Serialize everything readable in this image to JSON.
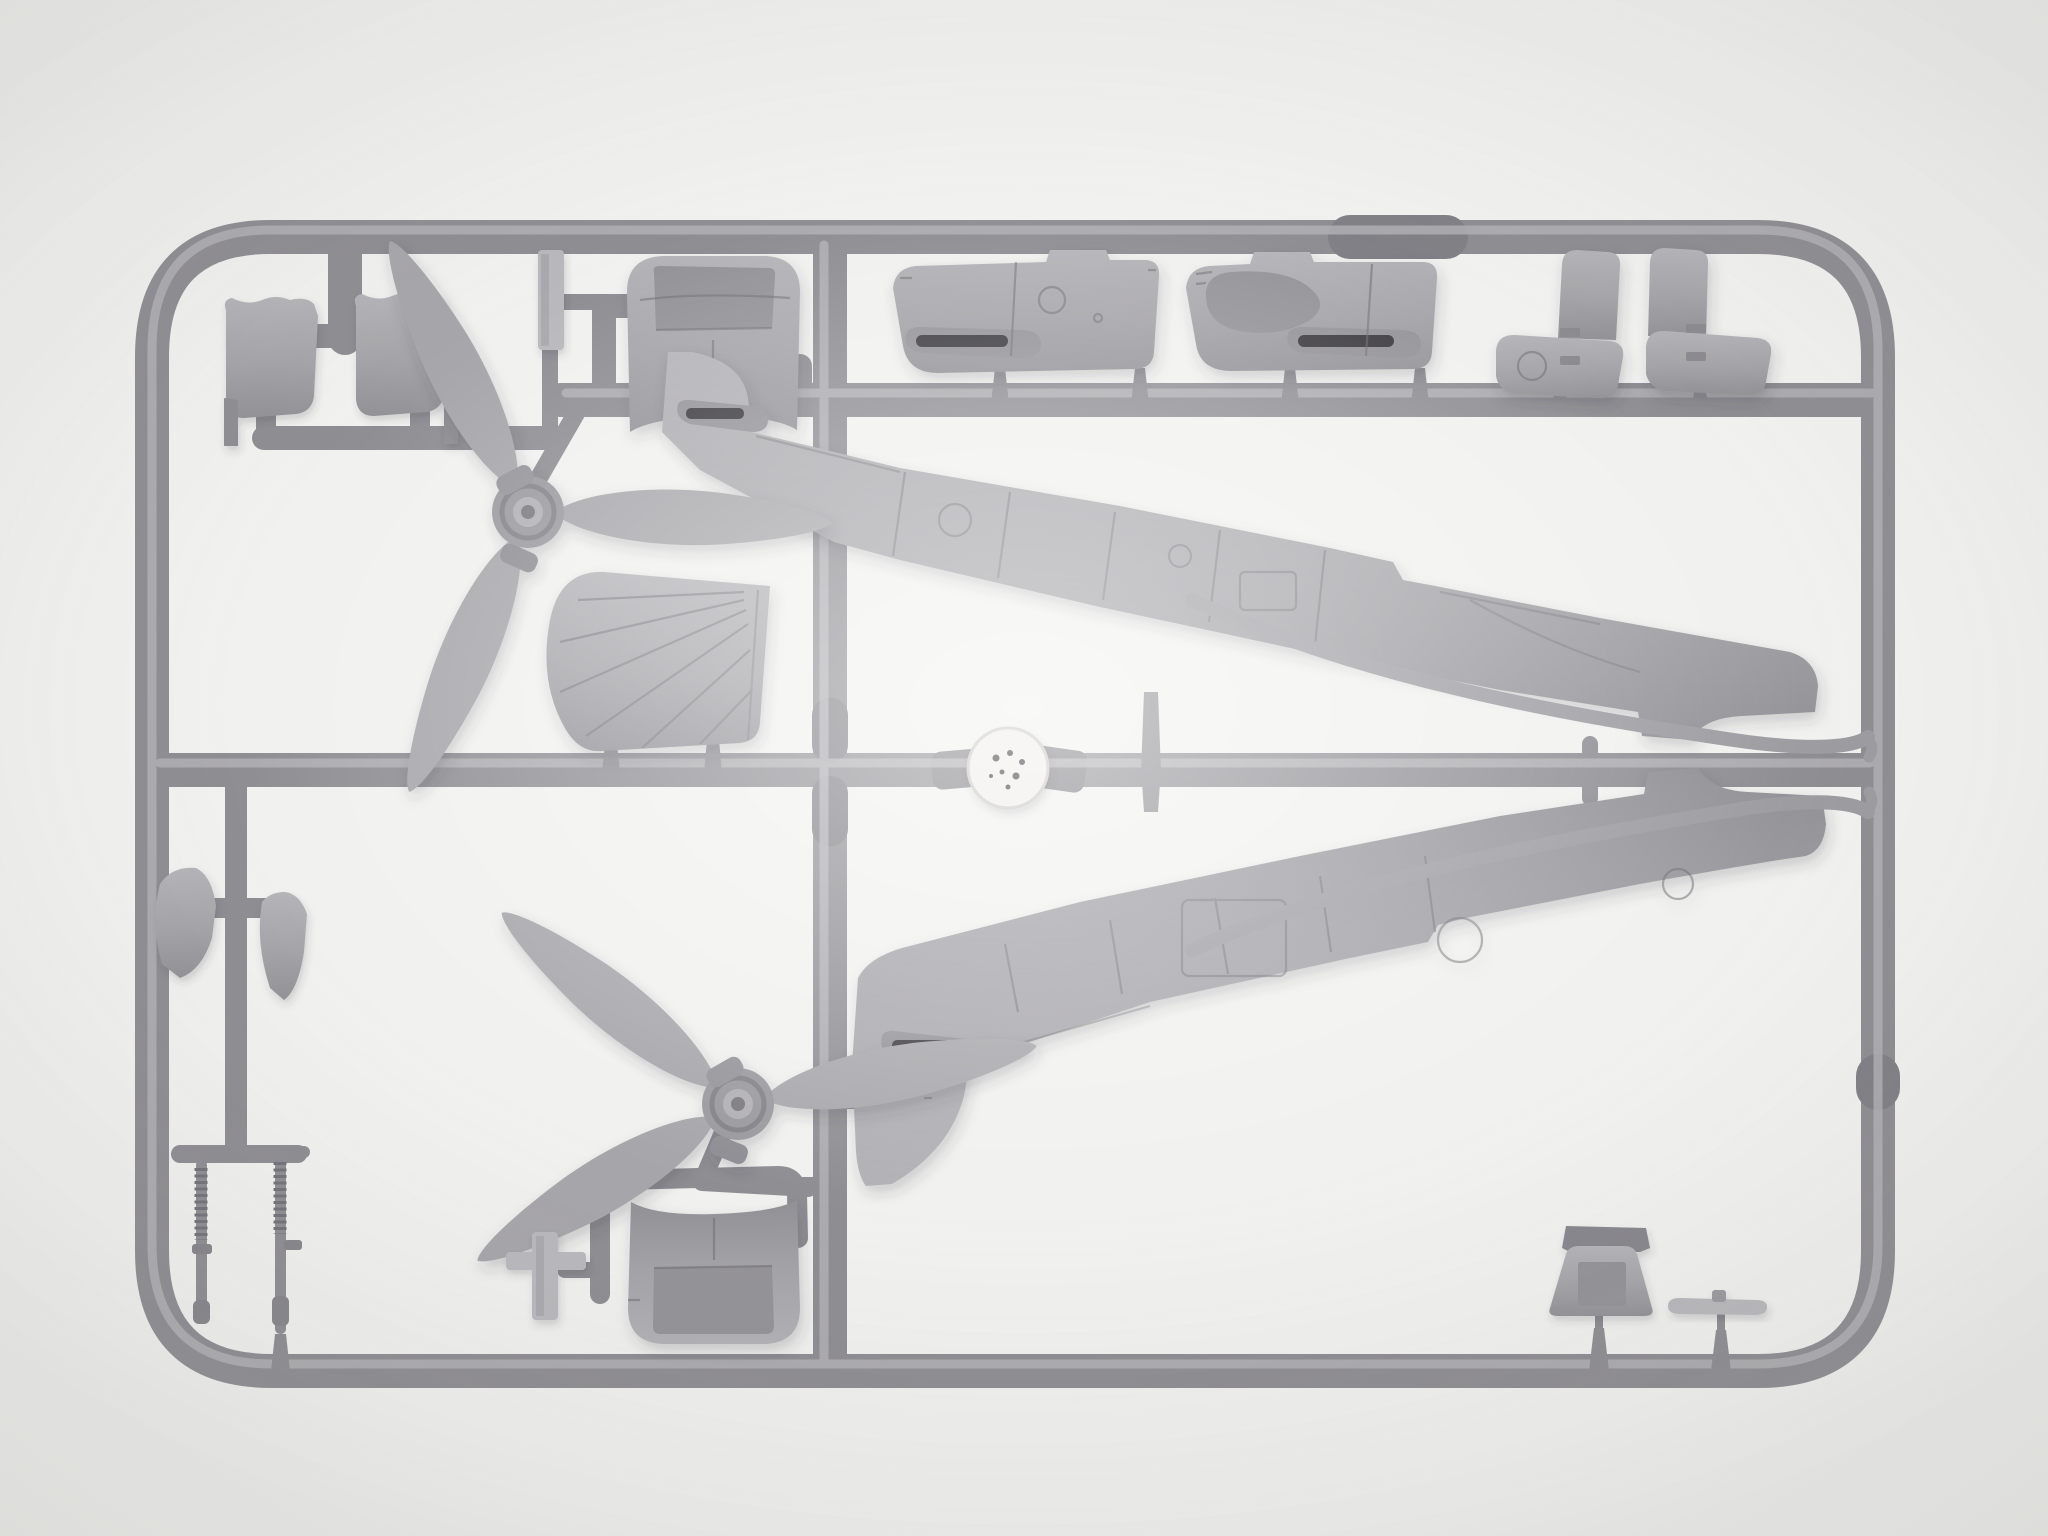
{
  "meta": {
    "type": "product-photo",
    "subject": "Injection-molded plastic model aircraft kit sprue, unpainted light gray styrene parts on a rectangular runner frame, photographed on a white background",
    "orientation": "landscape"
  },
  "scene": {
    "background": "white seamless studio background with soft vignette",
    "frame": "rounded rectangular sprue runner frame with internal runners, sleeves and tapered gates",
    "material": "light gray polystyrene",
    "lighting": "soft top light with faint drop shadows under parts"
  },
  "parts_inventory": [
    {
      "name": "fuselage half (side view, tail fin and panel lines)",
      "count": 2
    },
    {
      "name": "three-blade propeller with hub",
      "count": 2
    },
    {
      "name": "engine cowling side panel with exhaust trough",
      "count": 2
    },
    {
      "name": "nose cowl section (column + curved trough)",
      "count": 2
    },
    {
      "name": "fuselage spine / cowl deck saddle piece",
      "count": 2
    },
    {
      "name": "ribbed radiator fairing (D-shaped)",
      "count": 1
    },
    {
      "name": "windscreen frame part",
      "count": 1
    },
    {
      "name": "main landing gear leg with knurled oleo",
      "count": 2
    },
    {
      "name": "small curved bulkhead / head-armor plate",
      "count": 2
    },
    {
      "name": "small fin / wheel-door blade",
      "count": 2
    },
    {
      "name": "flat strip part",
      "count": 2
    },
    {
      "name": "curved exhaust fairing strip",
      "count": 2
    },
    {
      "name": "small flat tailplane blade",
      "count": 1
    },
    {
      "name": "round molding stamp disc on runner",
      "count": 1
    }
  ],
  "colors": {
    "background": "#f1f1ef",
    "sprue_base": "#8f8e93",
    "sprue_dark": "#818086",
    "sprue_highlight": "#b6b5b9",
    "part_fill": "#a7a6aa",
    "part_light": "#b9b8bc",
    "part_dark": "#8a898e",
    "recess": "#949398",
    "panel_line": "#6f6e73",
    "slot_dark": "#3c3b40",
    "disc_face": "#efedea",
    "disc_dot": "#39383c"
  }
}
